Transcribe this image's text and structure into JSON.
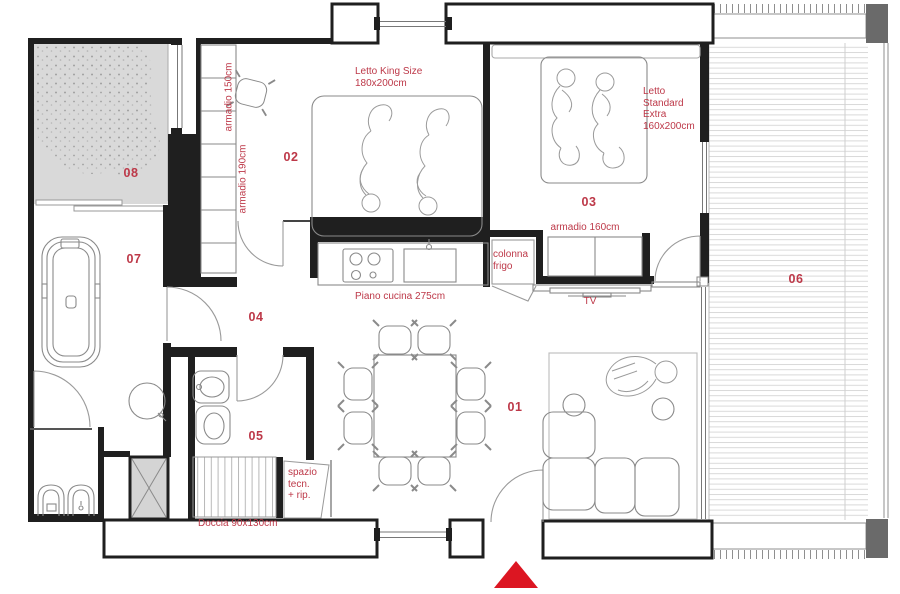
{
  "rooms": {
    "r01": "01",
    "r02": "02",
    "r03": "03",
    "r04": "04",
    "r05": "05",
    "r06": "06",
    "r07": "07",
    "r08": "08"
  },
  "labels": {
    "letto_king_line1": "Letto King Size",
    "letto_king_line2": "180x200cm",
    "letto_std_line1": "Letto",
    "letto_std_line2": "Standard",
    "letto_std_line3": "Extra",
    "letto_std_line4": "160x200cm",
    "armadio_150": "armadio 150cm",
    "armadio_190": "armadio 190cm",
    "armadio_160": "armadio 160cm",
    "colonna_line1": "colonna",
    "colonna_line2": "frigo",
    "piano_cucina": "Piano cucina 275cm",
    "tv": "TV",
    "spazio_line1": "spazio",
    "spazio_line2": "tecn.",
    "spazio_line3": "+ rip.",
    "doccia": "Doccia 90x130cm"
  },
  "colors": {
    "label_red": "#bd3848",
    "arrow_red": "#dc1622",
    "patio_gray": "#d9d9d9",
    "pillar_gray": "#6a6a6a",
    "wall_black": "#1f1f1f"
  }
}
